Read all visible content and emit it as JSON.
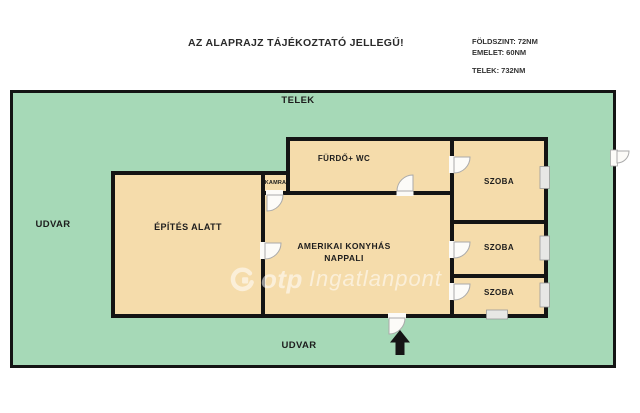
{
  "header": {
    "title": "AZ ALAPRAJZ TÁJÉKOZTATÓ JELLEGŰ!",
    "info": {
      "line1": "FÖLDSZINT: 72NM",
      "line2": "EMELET: 60NM",
      "line3": "TELEK: 732NM"
    }
  },
  "plot": {
    "label": "TELEK",
    "yard_left": "UDVAR",
    "yard_bottom": "UDVAR"
  },
  "rooms": {
    "epites_alatt": "ÉPÍTÉS ALATT",
    "kamra": "KAMRA",
    "furdo_wc": "FÜRDŐ+ WC",
    "nappali_line1": "AMERIKAI KONYHÁS",
    "nappali_line2": "NAPPALI",
    "szoba1": "SZOBA",
    "szoba2": "SZOBA",
    "szoba3": "SZOBA"
  },
  "watermark": {
    "brand": "otp",
    "suffix": "Ingatlanpont"
  },
  "icons": {
    "entrance_arrow": "up-arrow",
    "gate": "property-gate-door",
    "doors": "quarter-circle-door-swing",
    "windows": "wall-window-gap"
  },
  "colors": {
    "plot_green": "#a6d9b7",
    "room_tan": "#f5dcab",
    "wall": "#141414",
    "window_fill": "#e7e7e5",
    "door_fill": "#fcfbf8",
    "page_bg": "#ffffff"
  }
}
